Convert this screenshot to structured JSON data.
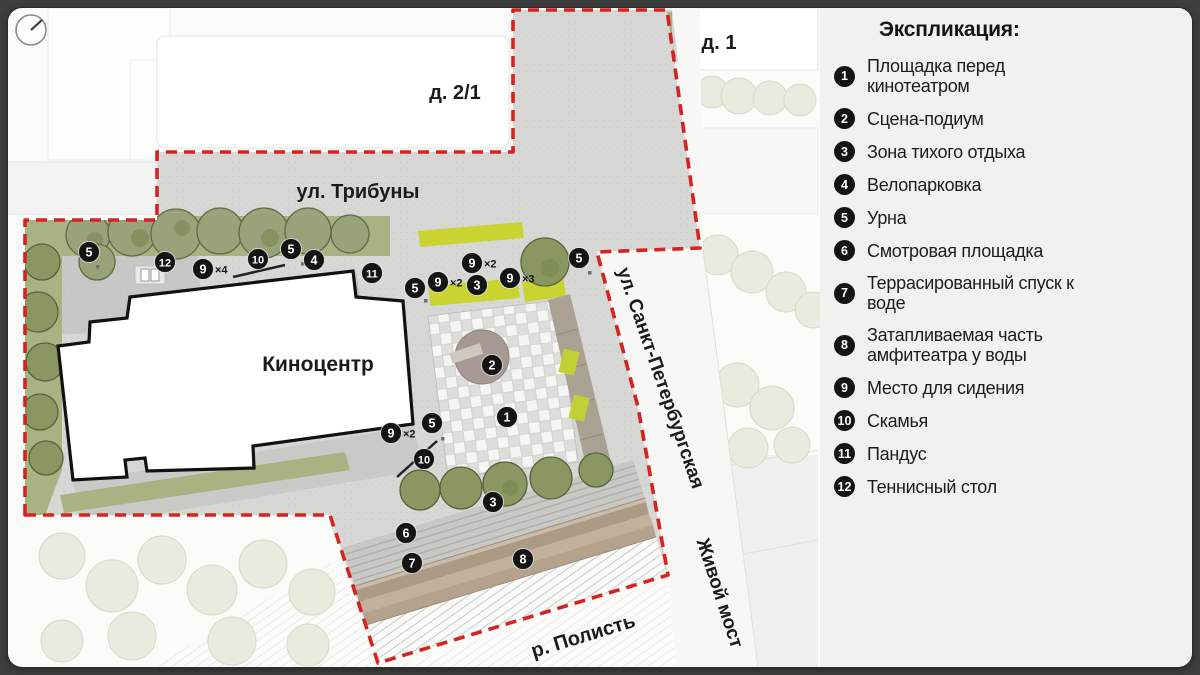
{
  "colors": {
    "frame": "#3e3e3e",
    "card": "#fbfbf9",
    "panel": "#f1f1ef",
    "boundary_red": "#d42421",
    "marker_black": "#141414",
    "lime": "#c9d430",
    "olive_band": "#a8b283",
    "tree_dark": "#7f8c5c",
    "road_white": "#f7f7f5",
    "paving": "#d7d7d5",
    "terrace_brown": "#b4a28c",
    "podium": "#a69893"
  },
  "legend": {
    "title": "Экспликация:",
    "items": [
      {
        "num": "1",
        "label": "Площадка перед кинотеатром"
      },
      {
        "num": "2",
        "label": "Сцена-подиум"
      },
      {
        "num": "3",
        "label": "Зона тихого отдыха"
      },
      {
        "num": "4",
        "label": "Велопарковка"
      },
      {
        "num": "5",
        "label": "Урна"
      },
      {
        "num": "6",
        "label": "Смотровая площадка"
      },
      {
        "num": "7",
        "label": "Террасированный спуск к воде"
      },
      {
        "num": "8",
        "label": "Затапливаемая часть амфитеатра у воды"
      },
      {
        "num": "9",
        "label": "Место для сидения"
      },
      {
        "num": "10",
        "label": "Скамья"
      },
      {
        "num": "11",
        "label": "Пандус"
      },
      {
        "num": "12",
        "label": "Теннисный стол"
      }
    ]
  },
  "map": {
    "labels": [
      {
        "id": "street-tribuny",
        "text": "ул. Трибуны",
        "x": 358,
        "y": 198,
        "size": 20,
        "rot": 0
      },
      {
        "id": "house-2-1",
        "text": "д. 2/1",
        "x": 455,
        "y": 99,
        "size": 20,
        "rot": 0
      },
      {
        "id": "house-1",
        "text": "д. 1",
        "x": 719,
        "y": 49,
        "size": 20,
        "rot": 0
      },
      {
        "id": "building-kinocentr",
        "text": "Киноцентр",
        "x": 318,
        "y": 371,
        "size": 21,
        "rot": 0
      },
      {
        "id": "street-spb",
        "text": "ул. Санкт-Петербургская",
        "x": 655,
        "y": 380,
        "size": 19,
        "rot": 71
      },
      {
        "id": "bridge-zhivoy",
        "text": "Живой мост",
        "x": 714,
        "y": 595,
        "size": 19,
        "rot": 72
      },
      {
        "id": "river-polist",
        "text": "р. Полисть",
        "x": 585,
        "y": 642,
        "size": 20,
        "rot": -17
      }
    ],
    "markers": [
      {
        "num": "1",
        "x": 507,
        "y": 417
      },
      {
        "num": "2",
        "x": 492,
        "y": 365
      },
      {
        "num": "3",
        "x": 477,
        "y": 285
      },
      {
        "num": "3",
        "x": 493,
        "y": 502
      },
      {
        "num": "4",
        "x": 314,
        "y": 260
      },
      {
        "num": "5",
        "x": 89,
        "y": 252
      },
      {
        "num": "5",
        "x": 291,
        "y": 249
      },
      {
        "num": "5",
        "x": 415,
        "y": 288
      },
      {
        "num": "5",
        "x": 579,
        "y": 258
      },
      {
        "num": "5",
        "x": 432,
        "y": 423
      },
      {
        "num": "6",
        "x": 406,
        "y": 533
      },
      {
        "num": "7",
        "x": 412,
        "y": 563
      },
      {
        "num": "8",
        "x": 523,
        "y": 559
      },
      {
        "num": "9",
        "x": 203,
        "y": 269,
        "mult": "×4"
      },
      {
        "num": "9",
        "x": 438,
        "y": 282,
        "mult": "×2"
      },
      {
        "num": "9",
        "x": 472,
        "y": 263,
        "mult": "×2"
      },
      {
        "num": "9",
        "x": 510,
        "y": 278,
        "mult": "×3"
      },
      {
        "num": "9",
        "x": 391,
        "y": 433,
        "mult": "×2"
      },
      {
        "num": "10",
        "x": 258,
        "y": 259
      },
      {
        "num": "10",
        "x": 424,
        "y": 459
      },
      {
        "num": "11",
        "x": 372,
        "y": 273
      },
      {
        "num": "12",
        "x": 165,
        "y": 262
      }
    ]
  }
}
